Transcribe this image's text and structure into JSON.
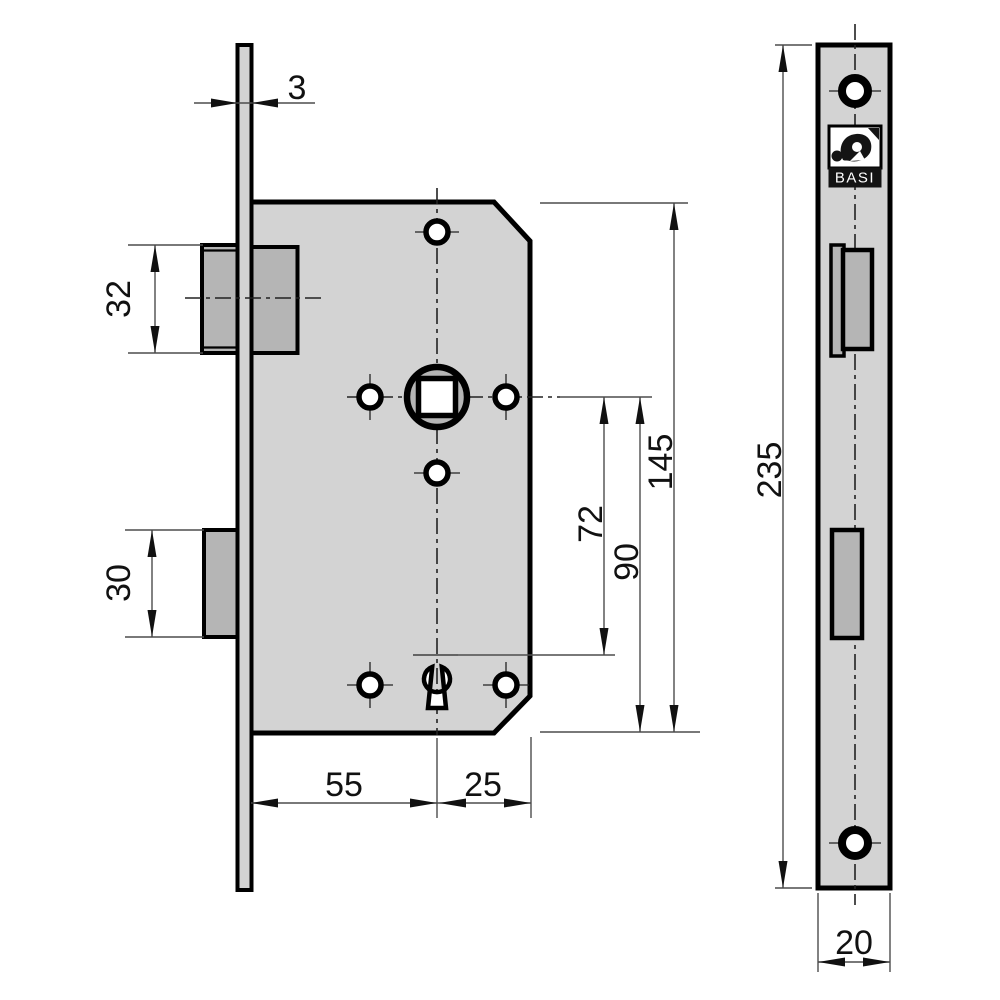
{
  "drawing": {
    "brand_label": "BASI",
    "dimensions": {
      "faceplate_thickness": "3",
      "latch_bolt_height": "32",
      "deadbolt_height": "30",
      "backset": "55",
      "spindle_to_case_back": "25",
      "spindle_to_keyhole": "72",
      "spindle_to_case_bottom": "90",
      "case_height": "145",
      "faceplate_length": "235",
      "faceplate_width": "20"
    },
    "colors": {
      "background": "#ffffff",
      "metal-light": "#d3d3d3",
      "metal-dark": "#b5b5b5",
      "outline": "#000000",
      "dim-line": "#4d4d4d",
      "text": "#111111"
    }
  }
}
